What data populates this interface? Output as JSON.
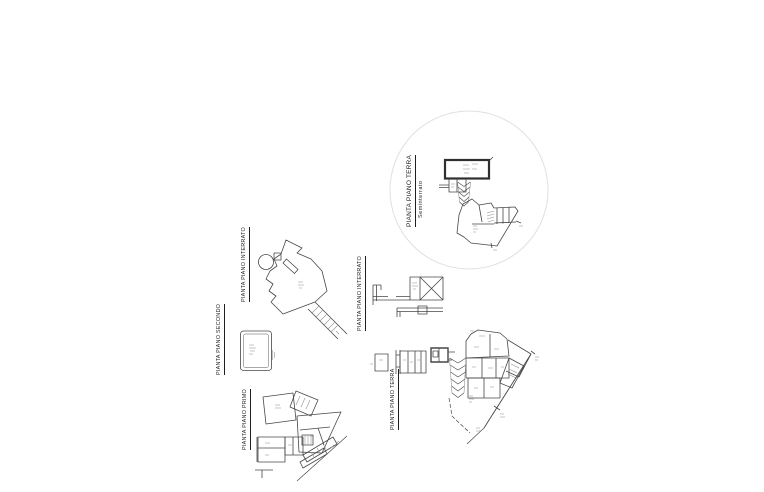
{
  "colors": {
    "background": "#ffffff",
    "line": "#474747",
    "wall": "#2f2f2f",
    "mark": "#8c8c8c",
    "circle_stroke": "#e0e0e0",
    "text": "#1f1f1f"
  },
  "plans": {
    "interrato_top": {
      "label": "PIANTA PIANO INTERRATO"
    },
    "secondo": {
      "label": "PIANTA PIANO SECONDO"
    },
    "primo": {
      "label": "PIANTA PIANO PRIMO"
    },
    "interrato_mid": {
      "label": "PIANTA PIANO INTERRATO"
    },
    "terra_circle": {
      "label": "PIANTA PIANO TERRA",
      "sublabel": "Seminterrato"
    },
    "terra_bottom": {
      "label": "PIANTA PIANO TERRA"
    }
  }
}
